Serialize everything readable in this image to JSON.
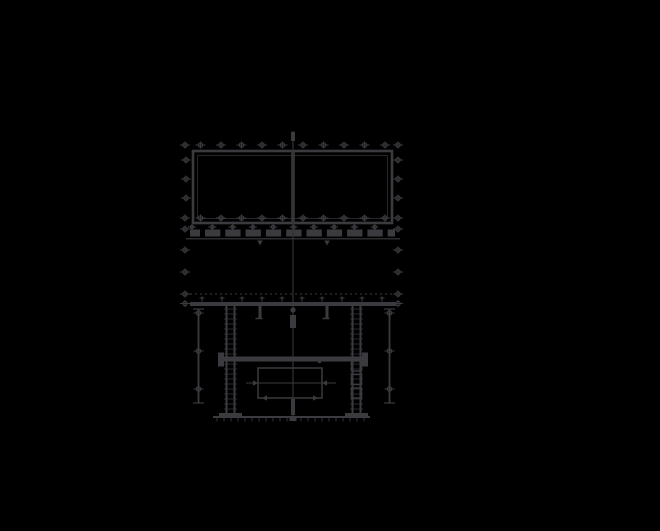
{
  "drawing": {
    "palette": {
      "background": "#000000",
      "ink": "#3b3b3f",
      "ink_dim": "#313134"
    },
    "viewport": {
      "width": 660,
      "height": 531
    },
    "elements": [
      {
        "type": "bolt-row",
        "name": "top-flange-bolt-row",
        "y": 145,
        "xs": [
          185,
          200.5,
          221,
          241.5,
          262,
          282.5,
          303,
          323.5,
          344,
          364.5,
          385,
          398
        ]
      },
      {
        "type": "rect",
        "name": "tank-outline",
        "x": 193,
        "y": 151,
        "w": 199,
        "h": 72,
        "sw": 2.6
      },
      {
        "type": "rect",
        "name": "tank-inner-line",
        "x": 197.5,
        "y": 155.5,
        "w": 190,
        "h": 63,
        "sw": 0.8,
        "dim": true
      },
      {
        "type": "line",
        "name": "tank-center-divider",
        "x1": 293,
        "y1": 151,
        "x2": 293,
        "y2": 223,
        "w": 3.5
      },
      {
        "type": "bolt-row",
        "name": "lower-flange-bolt-row",
        "y": 218,
        "xs": [
          185,
          200.5,
          221,
          241.5,
          262,
          282.5,
          303,
          323.5,
          344,
          364.5,
          385,
          398
        ]
      },
      {
        "type": "bolt-col",
        "name": "left-flange-bolt-column",
        "x": 186,
        "ys": [
          160,
          179,
          198
        ]
      },
      {
        "type": "bolt-col",
        "name": "right-flange-bolt-column",
        "x": 398,
        "ys": [
          160,
          179,
          198
        ]
      },
      {
        "type": "bolt-col",
        "name": "left-side-bolt-column",
        "x": 185,
        "ys": [
          229,
          250,
          272,
          294,
          303.5
        ]
      },
      {
        "type": "bolt-col",
        "name": "right-side-bolt-column",
        "x": 398,
        "ys": [
          229,
          250,
          272,
          294,
          303.5
        ]
      },
      {
        "type": "bolt-row",
        "name": "gasket-bolt-row",
        "y": 227,
        "from": 192,
        "to": 394.5,
        "step": 20.3,
        "r": 1.7,
        "wing": 4
      },
      {
        "type": "line",
        "name": "gasket-beam",
        "x1": 190,
        "y1": 233,
        "x2": 395,
        "y2": 233,
        "w": 7
      },
      {
        "type": "gap-row",
        "name": "gasket-beam-gaps",
        "y": 229,
        "h": 8.5,
        "w": 5,
        "from": 200,
        "to": 390,
        "step": 20.3
      },
      {
        "type": "line",
        "name": "gasket-base-line",
        "x1": 186,
        "y1": 238.8,
        "x2": 400,
        "y2": 238.8,
        "w": 1.2
      },
      {
        "type": "arrow",
        "name": "weld-arrow-left",
        "x": 260,
        "y": 240.5,
        "dir": "down",
        "s": 5
      },
      {
        "type": "arrow",
        "name": "weld-arrow-right",
        "x": 327,
        "y": 240.5,
        "dir": "down",
        "s": 5
      },
      {
        "type": "line",
        "name": "vertical-centerline",
        "x1": 293,
        "y1": 131,
        "x2": 293,
        "y2": 421,
        "w": 1.2,
        "dim": true
      },
      {
        "type": "rect",
        "name": "centerline-top-knob",
        "x": 291,
        "y": 132,
        "w": 4,
        "h": 9,
        "fill": true
      },
      {
        "type": "circle",
        "name": "centerline-bolt-knob",
        "cx": 293,
        "cy": 310,
        "r": 2.6
      },
      {
        "type": "rect",
        "name": "centerline-mid-knob",
        "x": 290,
        "y": 315,
        "w": 6,
        "h": 13,
        "fill": true
      },
      {
        "type": "rect",
        "name": "centerline-bottom-knob",
        "x": 291,
        "y": 399,
        "w": 4,
        "h": 16,
        "fill": true
      },
      {
        "type": "rect",
        "name": "centerline-base-foot",
        "x": 289.5,
        "y": 417,
        "w": 7,
        "h": 4,
        "fill": true
      },
      {
        "type": "line",
        "name": "foundation-dotted-line",
        "x1": 190,
        "y1": 294,
        "x2": 396,
        "y2": 294,
        "w": 1,
        "dash": "2 3"
      },
      {
        "type": "line",
        "name": "frame-top-beam",
        "x1": 190,
        "y1": 304,
        "x2": 396,
        "y2": 304,
        "w": 4
      },
      {
        "type": "tee-row",
        "name": "frame-top-beam-studs",
        "y": 302,
        "from": 202,
        "to": 382,
        "step": 20
      },
      {
        "type": "rect",
        "name": "left-hanger-bracket",
        "x": 258.5,
        "y": 306,
        "w": 3,
        "h": 12,
        "fill": true
      },
      {
        "type": "line",
        "name": "left-hanger-foot",
        "x1": 255.5,
        "y1": 318.5,
        "x2": 262.5,
        "y2": 318.5,
        "w": 1.5
      },
      {
        "type": "rect",
        "name": "right-hanger-bracket",
        "x": 325.5,
        "y": 306,
        "w": 3,
        "h": 12,
        "fill": true
      },
      {
        "type": "line",
        "name": "right-hanger-foot",
        "x1": 322.5,
        "y1": 318.5,
        "x2": 329.5,
        "y2": 318.5,
        "w": 1.5
      },
      {
        "type": "line",
        "name": "left-anchor-rod",
        "x1": 198.5,
        "y1": 309,
        "x2": 198.5,
        "y2": 403,
        "w": 1.8
      },
      {
        "type": "line",
        "name": "left-anchor-top-cap",
        "x1": 193,
        "y1": 309,
        "x2": 204,
        "y2": 309,
        "w": 1.2
      },
      {
        "type": "line",
        "name": "left-anchor-bottom-cap",
        "x1": 193,
        "y1": 403,
        "x2": 204,
        "y2": 403,
        "w": 1.2
      },
      {
        "type": "bolt-col",
        "name": "left-anchor-bolts",
        "x": 198.5,
        "ys": [
          313,
          351,
          389
        ]
      },
      {
        "type": "line",
        "name": "right-anchor-rod",
        "x1": 389.5,
        "y1": 309,
        "x2": 389.5,
        "y2": 403,
        "w": 1.8
      },
      {
        "type": "line",
        "name": "right-anchor-top-cap",
        "x1": 384,
        "y1": 309,
        "x2": 395,
        "y2": 309,
        "w": 1.2
      },
      {
        "type": "line",
        "name": "right-anchor-bottom-cap",
        "x1": 384,
        "y1": 403,
        "x2": 395,
        "y2": 403,
        "w": 1.2
      },
      {
        "type": "bolt-col",
        "name": "right-anchor-bolts",
        "x": 389.5,
        "ys": [
          313,
          351,
          389
        ]
      },
      {
        "type": "line",
        "name": "left-column-outer-flange",
        "x1": 226.5,
        "y1": 306,
        "x2": 226.5,
        "y2": 413,
        "w": 2
      },
      {
        "type": "line",
        "name": "left-column-inner-flange",
        "x1": 234.5,
        "y1": 306,
        "x2": 234.5,
        "y2": 413,
        "w": 2
      },
      {
        "type": "rungs",
        "name": "left-column-lacing",
        "x1": 224,
        "x2": 237,
        "from": 309,
        "to": 411,
        "step": 5,
        "w": 0.7
      },
      {
        "type": "rect",
        "name": "left-column-base-plate",
        "x": 219,
        "y": 413,
        "w": 23,
        "h": 3.5,
        "fill": true
      },
      {
        "type": "line",
        "name": "right-column-outer-flange",
        "x1": 360.5,
        "y1": 306,
        "x2": 360.5,
        "y2": 413,
        "w": 2
      },
      {
        "type": "line",
        "name": "right-column-inner-flange",
        "x1": 352.5,
        "y1": 306,
        "x2": 352.5,
        "y2": 413,
        "w": 2
      },
      {
        "type": "rungs",
        "name": "right-column-lacing",
        "x1": 350,
        "x2": 363,
        "from": 309,
        "to": 411,
        "step": 5,
        "w": 0.7
      },
      {
        "type": "rect",
        "name": "right-column-base-plate",
        "x": 345,
        "y": 413,
        "w": 23,
        "h": 3.5,
        "fill": true
      },
      {
        "type": "rect",
        "name": "right-column-splice-plate-1",
        "x": 351.5,
        "y": 361,
        "w": 10,
        "h": 10,
        "sw": 1.4
      },
      {
        "type": "rect",
        "name": "right-column-splice-plate-2",
        "x": 351.5,
        "y": 374.5,
        "w": 10,
        "h": 10,
        "sw": 1.4
      },
      {
        "type": "rect",
        "name": "right-column-splice-plate-3",
        "x": 351.5,
        "y": 388,
        "w": 10,
        "h": 10,
        "sw": 1.4
      },
      {
        "type": "line",
        "name": "mid-beam",
        "x1": 222,
        "y1": 359,
        "x2": 364,
        "y2": 359,
        "w": 5
      },
      {
        "type": "rect",
        "name": "mid-beam-left-end-plate",
        "x": 218,
        "y": 352.5,
        "w": 6,
        "h": 14,
        "fill": true
      },
      {
        "type": "rect",
        "name": "mid-beam-right-end-plate",
        "x": 362,
        "y": 352.5,
        "w": 6,
        "h": 14,
        "fill": true
      },
      {
        "type": "rect",
        "name": "conservator-box",
        "x": 258,
        "y": 368,
        "w": 64,
        "h": 30,
        "sw": 1.5
      },
      {
        "type": "line",
        "name": "conservator-mid-line",
        "x1": 246,
        "y1": 383,
        "x2": 336,
        "y2": 383,
        "w": 1
      },
      {
        "type": "arrow",
        "name": "box-dim-arrow-left",
        "x": 258,
        "y": 383,
        "dir": "right",
        "s": 5
      },
      {
        "type": "arrow",
        "name": "box-dim-arrow-right",
        "x": 322,
        "y": 383,
        "dir": "left",
        "s": 5
      },
      {
        "type": "arrow",
        "name": "box-bottom-arrow-left",
        "x": 262,
        "y": 398,
        "dir": "left",
        "s": 5
      },
      {
        "type": "arrow",
        "name": "box-bottom-arrow-right",
        "x": 318,
        "y": 398,
        "dir": "right",
        "s": 5
      },
      {
        "type": "rect",
        "name": "weld-mark",
        "x": 318,
        "y": 360,
        "w": 3,
        "h": 3,
        "fill": true
      },
      {
        "type": "line",
        "name": "ground-line",
        "x1": 213,
        "y1": 417,
        "x2": 370,
        "y2": 417,
        "w": 2
      },
      {
        "type": "hatch",
        "name": "ground-hatch",
        "y1": 417.5,
        "y2": 421.5,
        "from": 217,
        "to": 367,
        "step": 7,
        "w": 0.8
      }
    ]
  }
}
